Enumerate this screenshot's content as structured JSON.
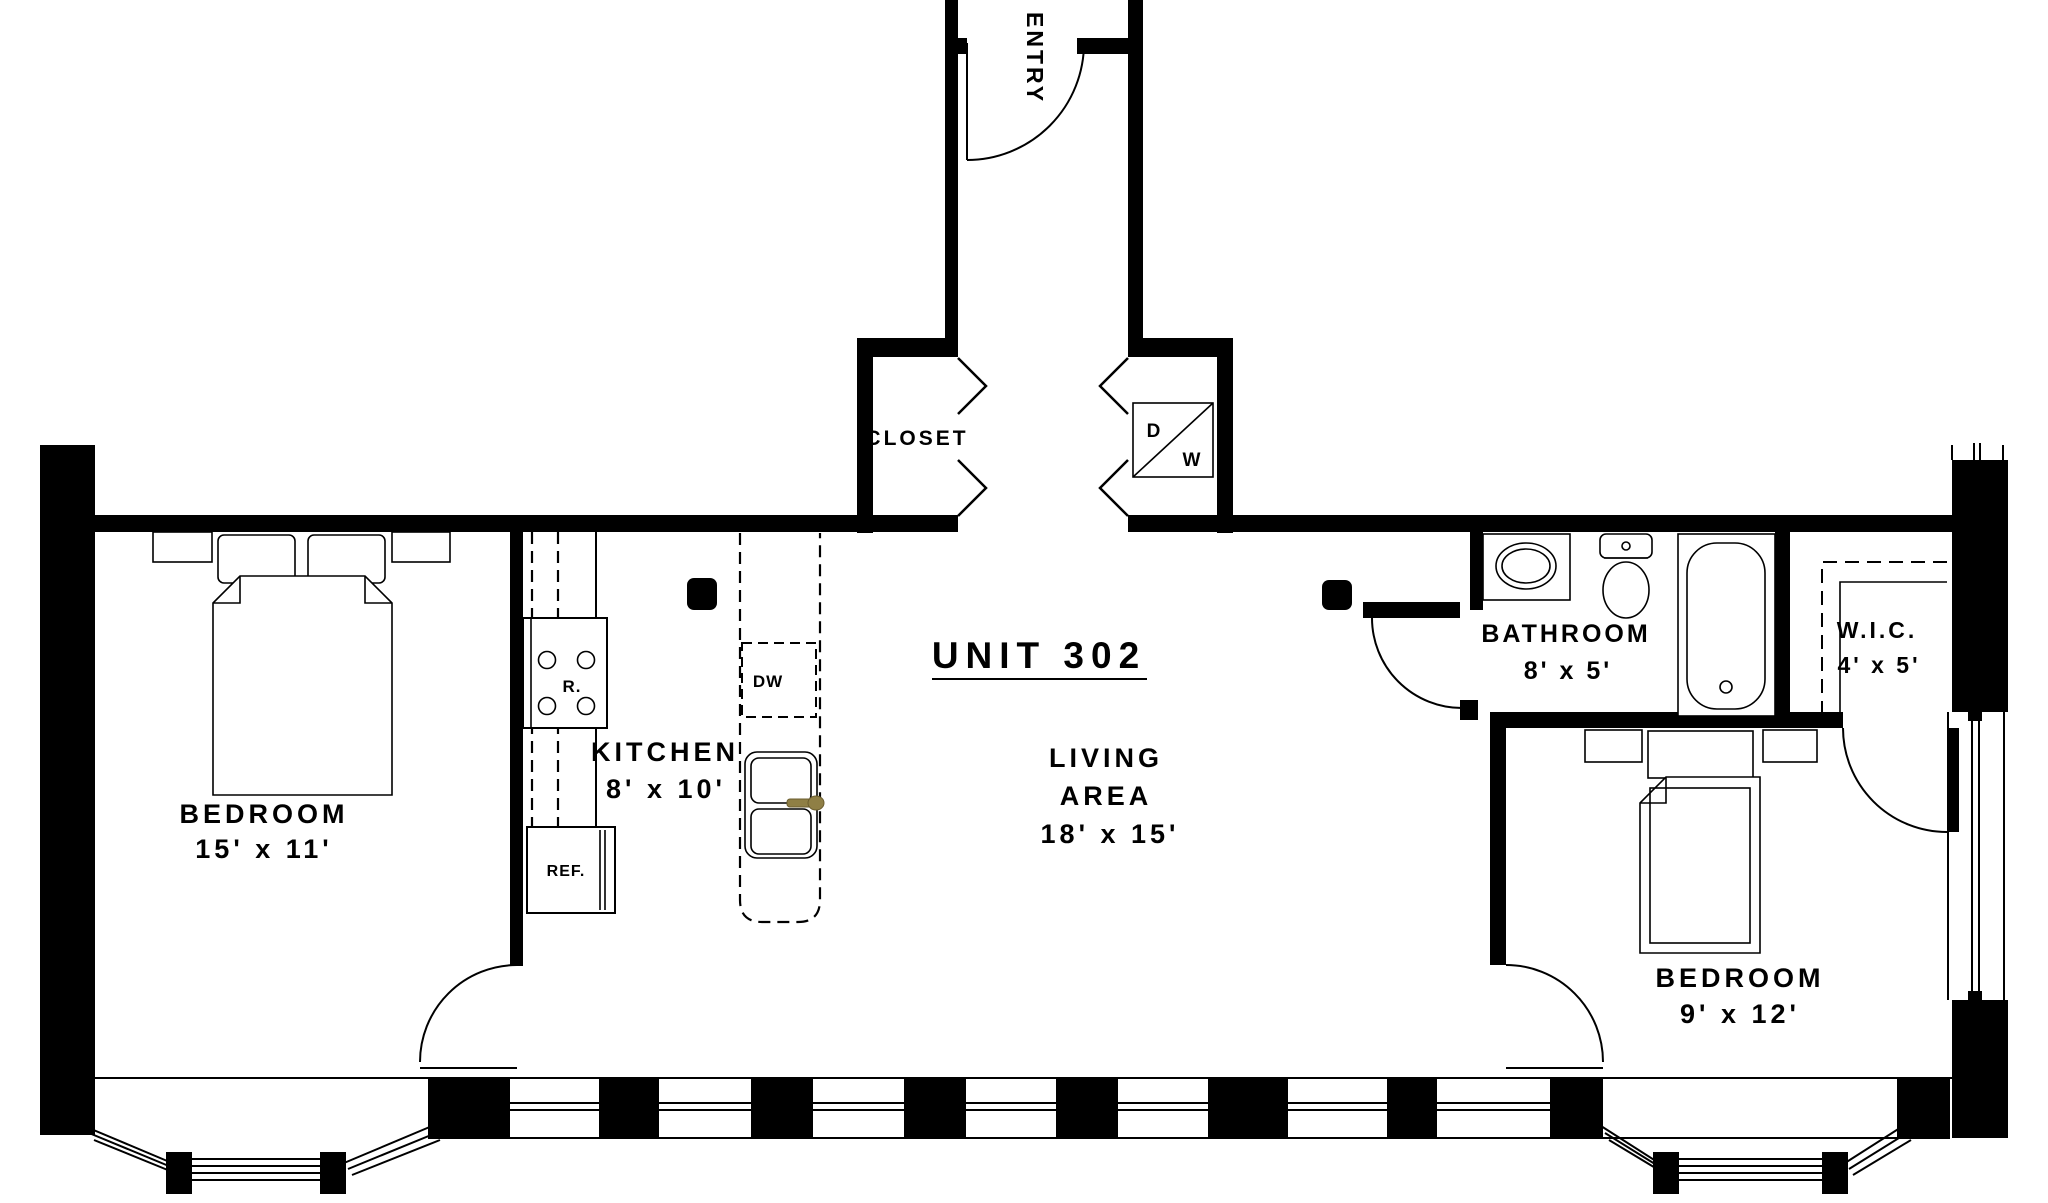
{
  "unit": {
    "title": "UNIT 302"
  },
  "rooms": {
    "entry": {
      "label": "ENTRY"
    },
    "closet": {
      "label": "CLOSET"
    },
    "bedroom_left": {
      "label": "BEDROOM",
      "dims": "15' x 11'"
    },
    "kitchen": {
      "label": "KITCHEN",
      "dims": "8' x 10'"
    },
    "living": {
      "label1": "LIVING",
      "label2": "AREA",
      "dims": "18' x 15'"
    },
    "bathroom": {
      "label": "BATHROOM",
      "dims": "8' x 5'"
    },
    "wic": {
      "label": "W.I.C.",
      "dims": "4' x 5'"
    },
    "bedroom_right": {
      "label": "BEDROOM",
      "dims": "9' x 12'"
    }
  },
  "appliances": {
    "range": "R.",
    "dishwasher": "DW",
    "refrigerator": "REF.",
    "dryer": "D",
    "washer": "W"
  },
  "colors": {
    "wall": "#000000",
    "background": "#ffffff",
    "faucet": "#8f7f45",
    "faucet_stroke": "#6b5d2e"
  }
}
